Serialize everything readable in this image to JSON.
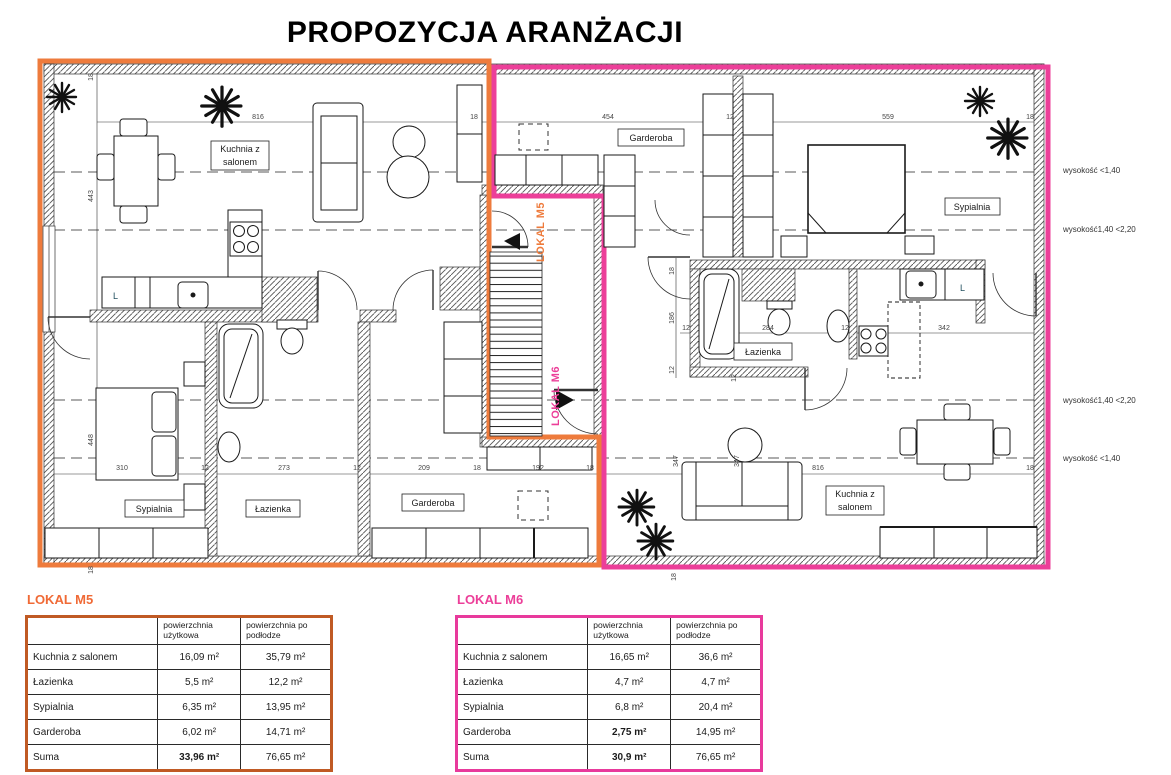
{
  "title": "PROPOZYCJA ARANŻACJI",
  "colors": {
    "m5_accent": "#ee7b3c",
    "m6_accent": "#ec3f99"
  },
  "plan": {
    "unit_labels": {
      "m5": "LOKAL M5",
      "m6": "LOKAL M6"
    },
    "rooms": {
      "kuchnia1": "Kuchnia z",
      "kuchnia2": "salonem",
      "sypialnia": "Sypialnia",
      "lazienka": "Łazienka",
      "garderoba": "Garderoba",
      "fridge": "L"
    },
    "heights": {
      "lt140": "wysokość <1,40",
      "h140_220": "wysokość1,40 <2,20"
    },
    "dims": {
      "d18": "18",
      "d12": "12",
      "d816": "816",
      "d454": "454",
      "d559": "559",
      "d443": "443",
      "d448": "448",
      "d310": "310",
      "d273": "273",
      "d209": "209",
      "d192": "192",
      "d186": "186",
      "d284": "284",
      "d342": "342",
      "d347": "347"
    }
  },
  "tables": {
    "m5": {
      "title": "LOKAL M5",
      "col_a": "powierzchnia użytkowa",
      "col_b": "powierzchnia po podłodze",
      "rows": [
        {
          "name": "Kuchnia z salonem",
          "a": "16,09 m²",
          "b": "35,79 m²"
        },
        {
          "name": "Łazienka",
          "a": "5,5 m²",
          "b": "12,2 m²"
        },
        {
          "name": "Sypialnia",
          "a": "6,35 m²",
          "b": "13,95 m²"
        },
        {
          "name": "Garderoba",
          "a": "6,02 m²",
          "b": "14,71 m²"
        },
        {
          "name": "Suma",
          "a": "33,96 m²",
          "b": "76,65 m²"
        }
      ]
    },
    "m6": {
      "title": "LOKAL M6",
      "col_a": "powierzchnia użytkowa",
      "col_b": "powierzchnia po podłodze",
      "rows": [
        {
          "name": "Kuchnia z salonem",
          "a": "16,65 m²",
          "b": "36,6 m²"
        },
        {
          "name": "Łazienka",
          "a": "4,7 m²",
          "b": "4,7 m²"
        },
        {
          "name": "Sypialnia",
          "a": "6,8 m²",
          "b": "20,4 m²"
        },
        {
          "name": "Garderoba",
          "a": "2,75 m²",
          "b": "14,95 m²"
        },
        {
          "name": "Suma",
          "a": "30,9 m²",
          "b": "76,65 m²"
        }
      ]
    }
  }
}
